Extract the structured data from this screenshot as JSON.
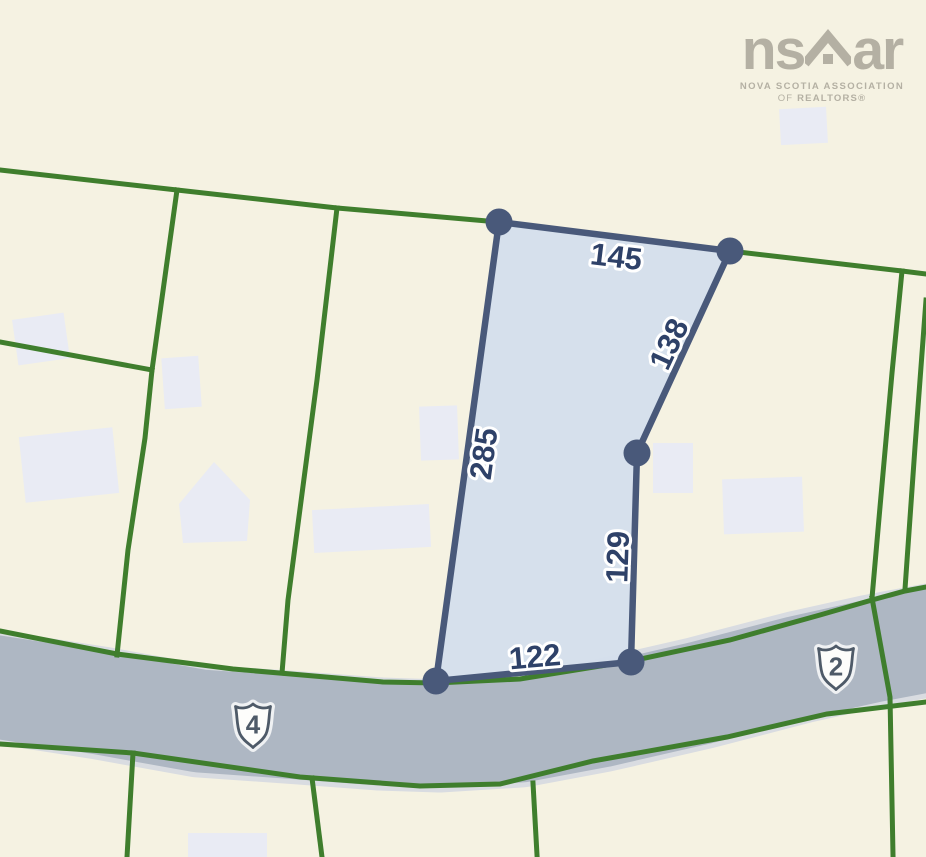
{
  "map": {
    "parcel": {
      "dimension_labels": {
        "top": "145",
        "upper_right": "138",
        "left": "285",
        "lower_right": "129",
        "bottom": "122"
      }
    },
    "route_markers": [
      {
        "number": "4"
      },
      {
        "number": "2"
      }
    ],
    "colors": {
      "background": "#f5f2e2",
      "boundary_green": "#3f7e2d",
      "road_fill": "#aeb7c3",
      "road_casing": "#d9dce1",
      "parcel_fill": "#d4dfec",
      "parcel_outline": "#49597a",
      "dimension_text": "#2e4168",
      "building_fill": "#e9ebf4",
      "shield_fill": "#fdfdfb",
      "shield_text": "#4e5a68",
      "logo_gray": "#b4b0a3"
    }
  },
  "watermark": {
    "brand_ns": "ns",
    "brand_ar": "ar",
    "org_line1": "NOVA SCOTIA ASSOCIATION",
    "org_line2_of": "OF",
    "org_line2_realtors": "REALTORS®"
  }
}
